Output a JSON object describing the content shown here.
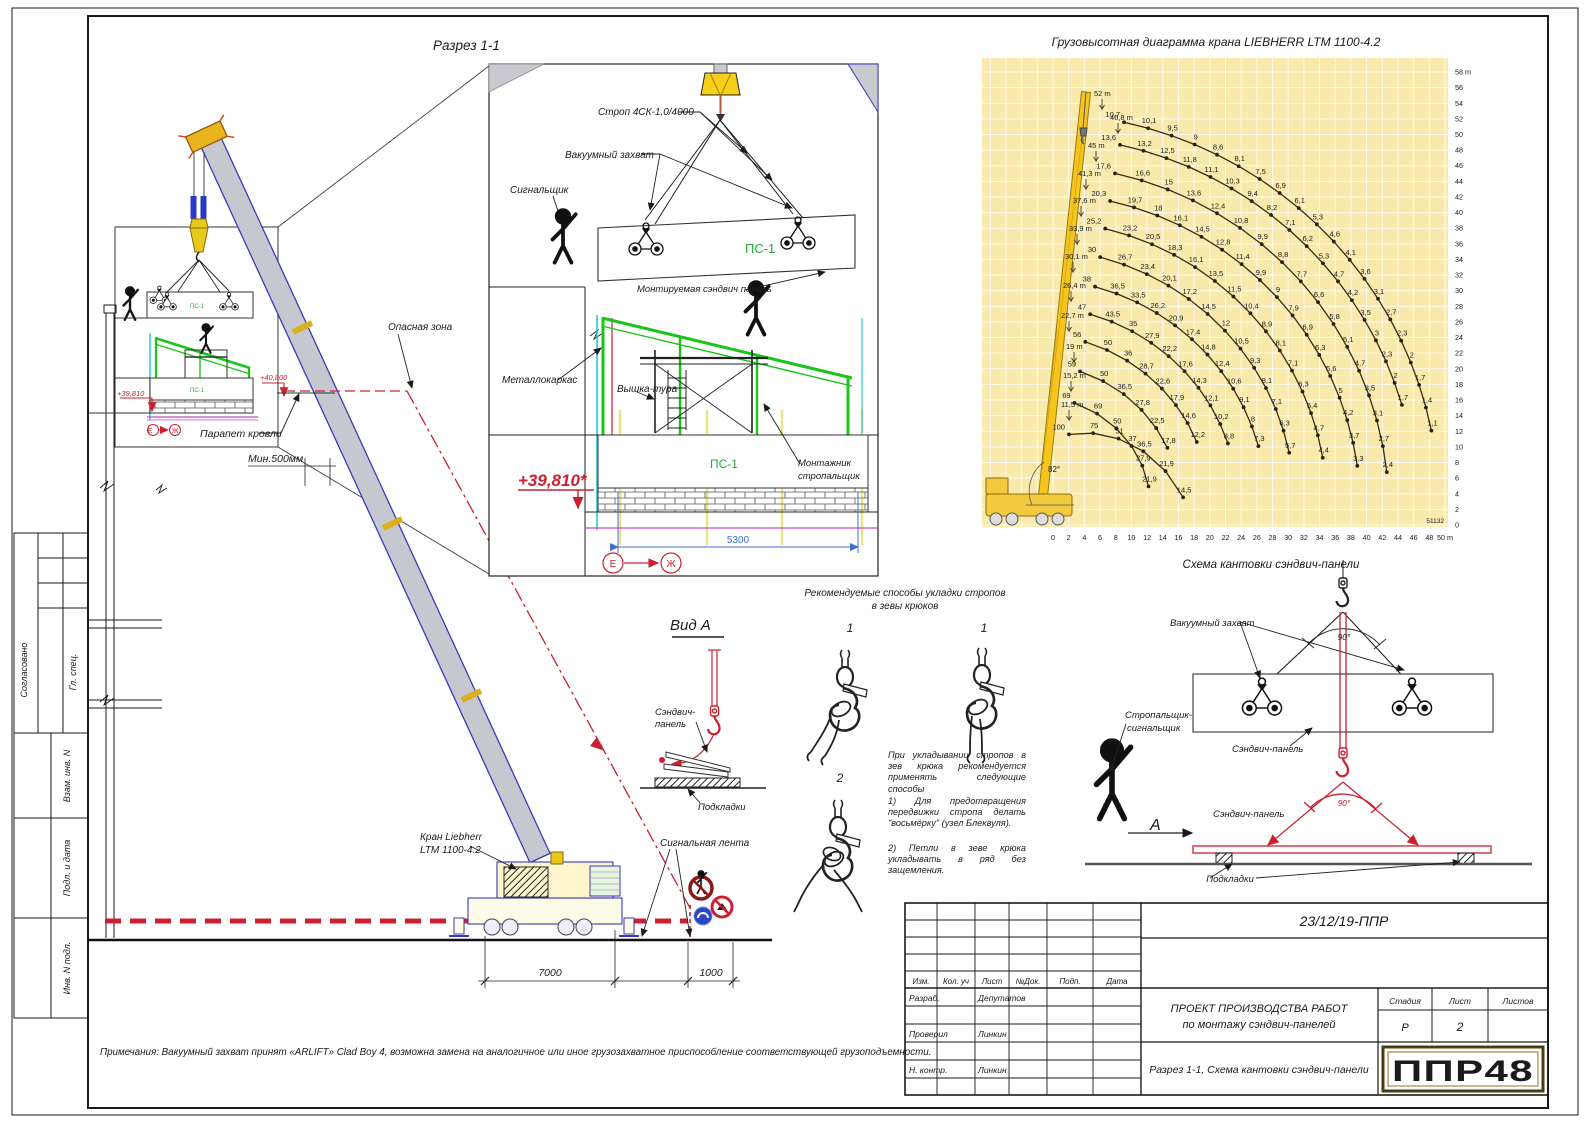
{
  "sheet": {
    "note": "Примечания: Вакуумный захват принят «ARLIFT» Clad Boy 4, возможна замена на аналогичное или иное грузозахватное приспособление соответствующей грузоподъемности.",
    "side": {
      "approved": "Согласовано",
      "chief": "Гл. спец.",
      "vzam": "Взам. инв. N",
      "podl": "Подл. и дата",
      "inv": "Инв. N подл."
    }
  },
  "section": {
    "title": "Разрез 1-1",
    "danger": "Опасная зона",
    "parapet": "Парапет кровли",
    "min_gap": "Мин.500мм",
    "tape": "Сигнальная лента",
    "crane1": "Кран Liebherr",
    "crane2": "LTM 1100-4.2",
    "d7000": "7000",
    "d1000": "1000",
    "elev1": "+39,810",
    "elev2": "+40,800",
    "ps1": "ПС-1",
    "axis_e": "Е",
    "axis_zh": "Ж"
  },
  "detail": {
    "sling": "Строп 4СК-1,0/4000",
    "vacuum": "Вакуумный захват",
    "signalman": "Сигнальщик",
    "ps1": "ПС-1",
    "mounted": "Монтируемая сэндвич панель",
    "frame": "Металлокаркас",
    "tower": "Вышка-тура",
    "wall_ps1": "ПС-1",
    "worker1": "Монтажник",
    "worker2": "стропальщик",
    "elev": "+39,810*",
    "d5300": "5300",
    "axis_e": "Е",
    "axis_zh": "Ж"
  },
  "chart_data": {
    "type": "line",
    "title": "Грузовысотная диаграмма крана LIEBHERR LTM 1100-4.2",
    "xlabel": "вылет, m",
    "ylabel": "высота подъема, m",
    "xlim": [
      0,
      50
    ],
    "ylim": [
      0,
      58
    ],
    "x_tick_step": 2,
    "y_tick_step": 2,
    "x_last_tick": "50 m",
    "y_top_tick": "58 m",
    "grid": true,
    "angle_label": "82°",
    "figure_code": "51132",
    "boom_labels": [
      "52 m",
      "46,8 m",
      "45 m",
      "41,3 m",
      "37,6 m",
      "33,9 m",
      "30,1 m",
      "26,4 m",
      "22,7 m",
      "19 m",
      "15,2 m",
      "11,5 m"
    ],
    "series": [
      {
        "boom": "46,8 m",
        "values": [
          10.7,
          10.1,
          9.5,
          9,
          8.6,
          8.1,
          7.5,
          6.9,
          6.1,
          5.3,
          4.6,
          4.1,
          3.6,
          3.1,
          2.7,
          2.3,
          2,
          1.7,
          1.4,
          1.1
        ]
      },
      {
        "boom": "45 m",
        "values": [
          13.6,
          13.2,
          12.5,
          11.8,
          11.1,
          10.3,
          9.4,
          8.2,
          7.1,
          6.2,
          5.3,
          4.7,
          4.2,
          3.5,
          3,
          2.3,
          2,
          1.7
        ]
      },
      {
        "boom": "41,3 m",
        "values": [
          17.6,
          16.6,
          15,
          13.6,
          12.4,
          10.8,
          9.9,
          8.8,
          7.7,
          6.6,
          5.8,
          5.1,
          4.7,
          3.5,
          3.1,
          2.7,
          2.4
        ]
      },
      {
        "boom": "37,6 m",
        "values": [
          20.3,
          19.7,
          18,
          16.1,
          14.5,
          12.8,
          11.4,
          9.9,
          9,
          7.9,
          6.9,
          6.3,
          5.6,
          5,
          4.2,
          3.7,
          3.3
        ]
      },
      {
        "boom": "33,9 m",
        "values": [
          25.2,
          23.2,
          20.5,
          18.3,
          16.1,
          13.5,
          11.5,
          10.4,
          8.9,
          8.1,
          7.1,
          6.3,
          5.4,
          4.7,
          4.4
        ]
      },
      {
        "boom": "30,1 m",
        "values": [
          30,
          26.7,
          23.4,
          20.1,
          17.2,
          14.5,
          12,
          10.5,
          9.3,
          8.1,
          7.1,
          6.3,
          5.7
        ]
      },
      {
        "boom": "26,4 m",
        "values": [
          38,
          36.5,
          33.5,
          26.2,
          20.9,
          17.4,
          14.8,
          12.4,
          10.6,
          9.1,
          8,
          7.3
        ]
      },
      {
        "boom": "22,7 m",
        "values": [
          47,
          43.5,
          35,
          27.9,
          22.2,
          17.6,
          14.3,
          12.1,
          10.2,
          8.8
        ]
      },
      {
        "boom": "19 m",
        "values": [
          56,
          50,
          36,
          28.7,
          22.6,
          17.9,
          14.6,
          12.2
        ]
      },
      {
        "boom": "15,2 m",
        "values": [
          59,
          50,
          36.5,
          27.8,
          22.5,
          17.8
        ]
      },
      {
        "boom": "11,5 m",
        "values": [
          69,
          69,
          50,
          37,
          27.9,
          21.9
        ]
      },
      {
        "boom": "",
        "values": [
          100,
          75,
          51,
          36.5,
          21.9,
          14.5
        ]
      }
    ]
  },
  "kantovka": {
    "title": "Схема кантовки сэндвич-панели",
    "vacuum": "Вакуумный захват",
    "rigger1": "Стропальщик-",
    "rigger2": "сигнальщик",
    "panel_top": "Сэндвич-панель",
    "panel_bottom": "Сэндвич-панель",
    "pads": "Подкладки",
    "angle_top": "90°",
    "angle_bottom": "90°",
    "view_mark": "А"
  },
  "vida": {
    "title": "Вид А",
    "panel1": "Сэндвич-",
    "panel2": "панель",
    "pads": "Подкладки"
  },
  "methods": {
    "title1": "Рекомендуемые способы укладки стропов",
    "title2": "в зевы крюков",
    "n1": "1",
    "n2": "1",
    "n3": "2",
    "p1": "При укладывании стропов в зев крюка рекомендуется применять следующие способы",
    "p2": "1)  Для предотвращения передвижки стропа делать \"восьмёрку\" (узел Блеквуля).",
    "p3": "2)  Петли в зеве крюка укладывать в ряд без защемления."
  },
  "titleblock": {
    "doc": "23/12/19-ППР",
    "h_izm": "Изм.",
    "h_kol": "Кол. уч",
    "h_list": "Лист",
    "h_dok": "№Док.",
    "h_podp": "Подп.",
    "h_data": "Дата",
    "razrab": "Разраб.",
    "razrab_n": "Депутатов",
    "prov": "Проверил",
    "prov_n": "Линкин",
    "nk": "Н. контр.",
    "nk_n": "Линкин",
    "proj1": "ПРОЕКТ ПРОИЗВОДСТВА РАБОТ",
    "proj2": "по монтажу сэндвич-панелей",
    "stadia": "Стадия",
    "list": "Лист",
    "listov": "Листов",
    "stadia_v": "Р",
    "list_v": "2",
    "listov_v": "",
    "subtitle": "Разрез 1-1, Схема кантовки сэндвич-панели",
    "logo": "ППР48"
  },
  "colors": {
    "chart_bg": "#f9e9ab",
    "crane_yellow": "#f3c93d",
    "accent_red": "#cc2030",
    "structure_green": "#1ec321",
    "dim_blue": "#3b6fd6",
    "logo_green": "#2e9e45"
  }
}
